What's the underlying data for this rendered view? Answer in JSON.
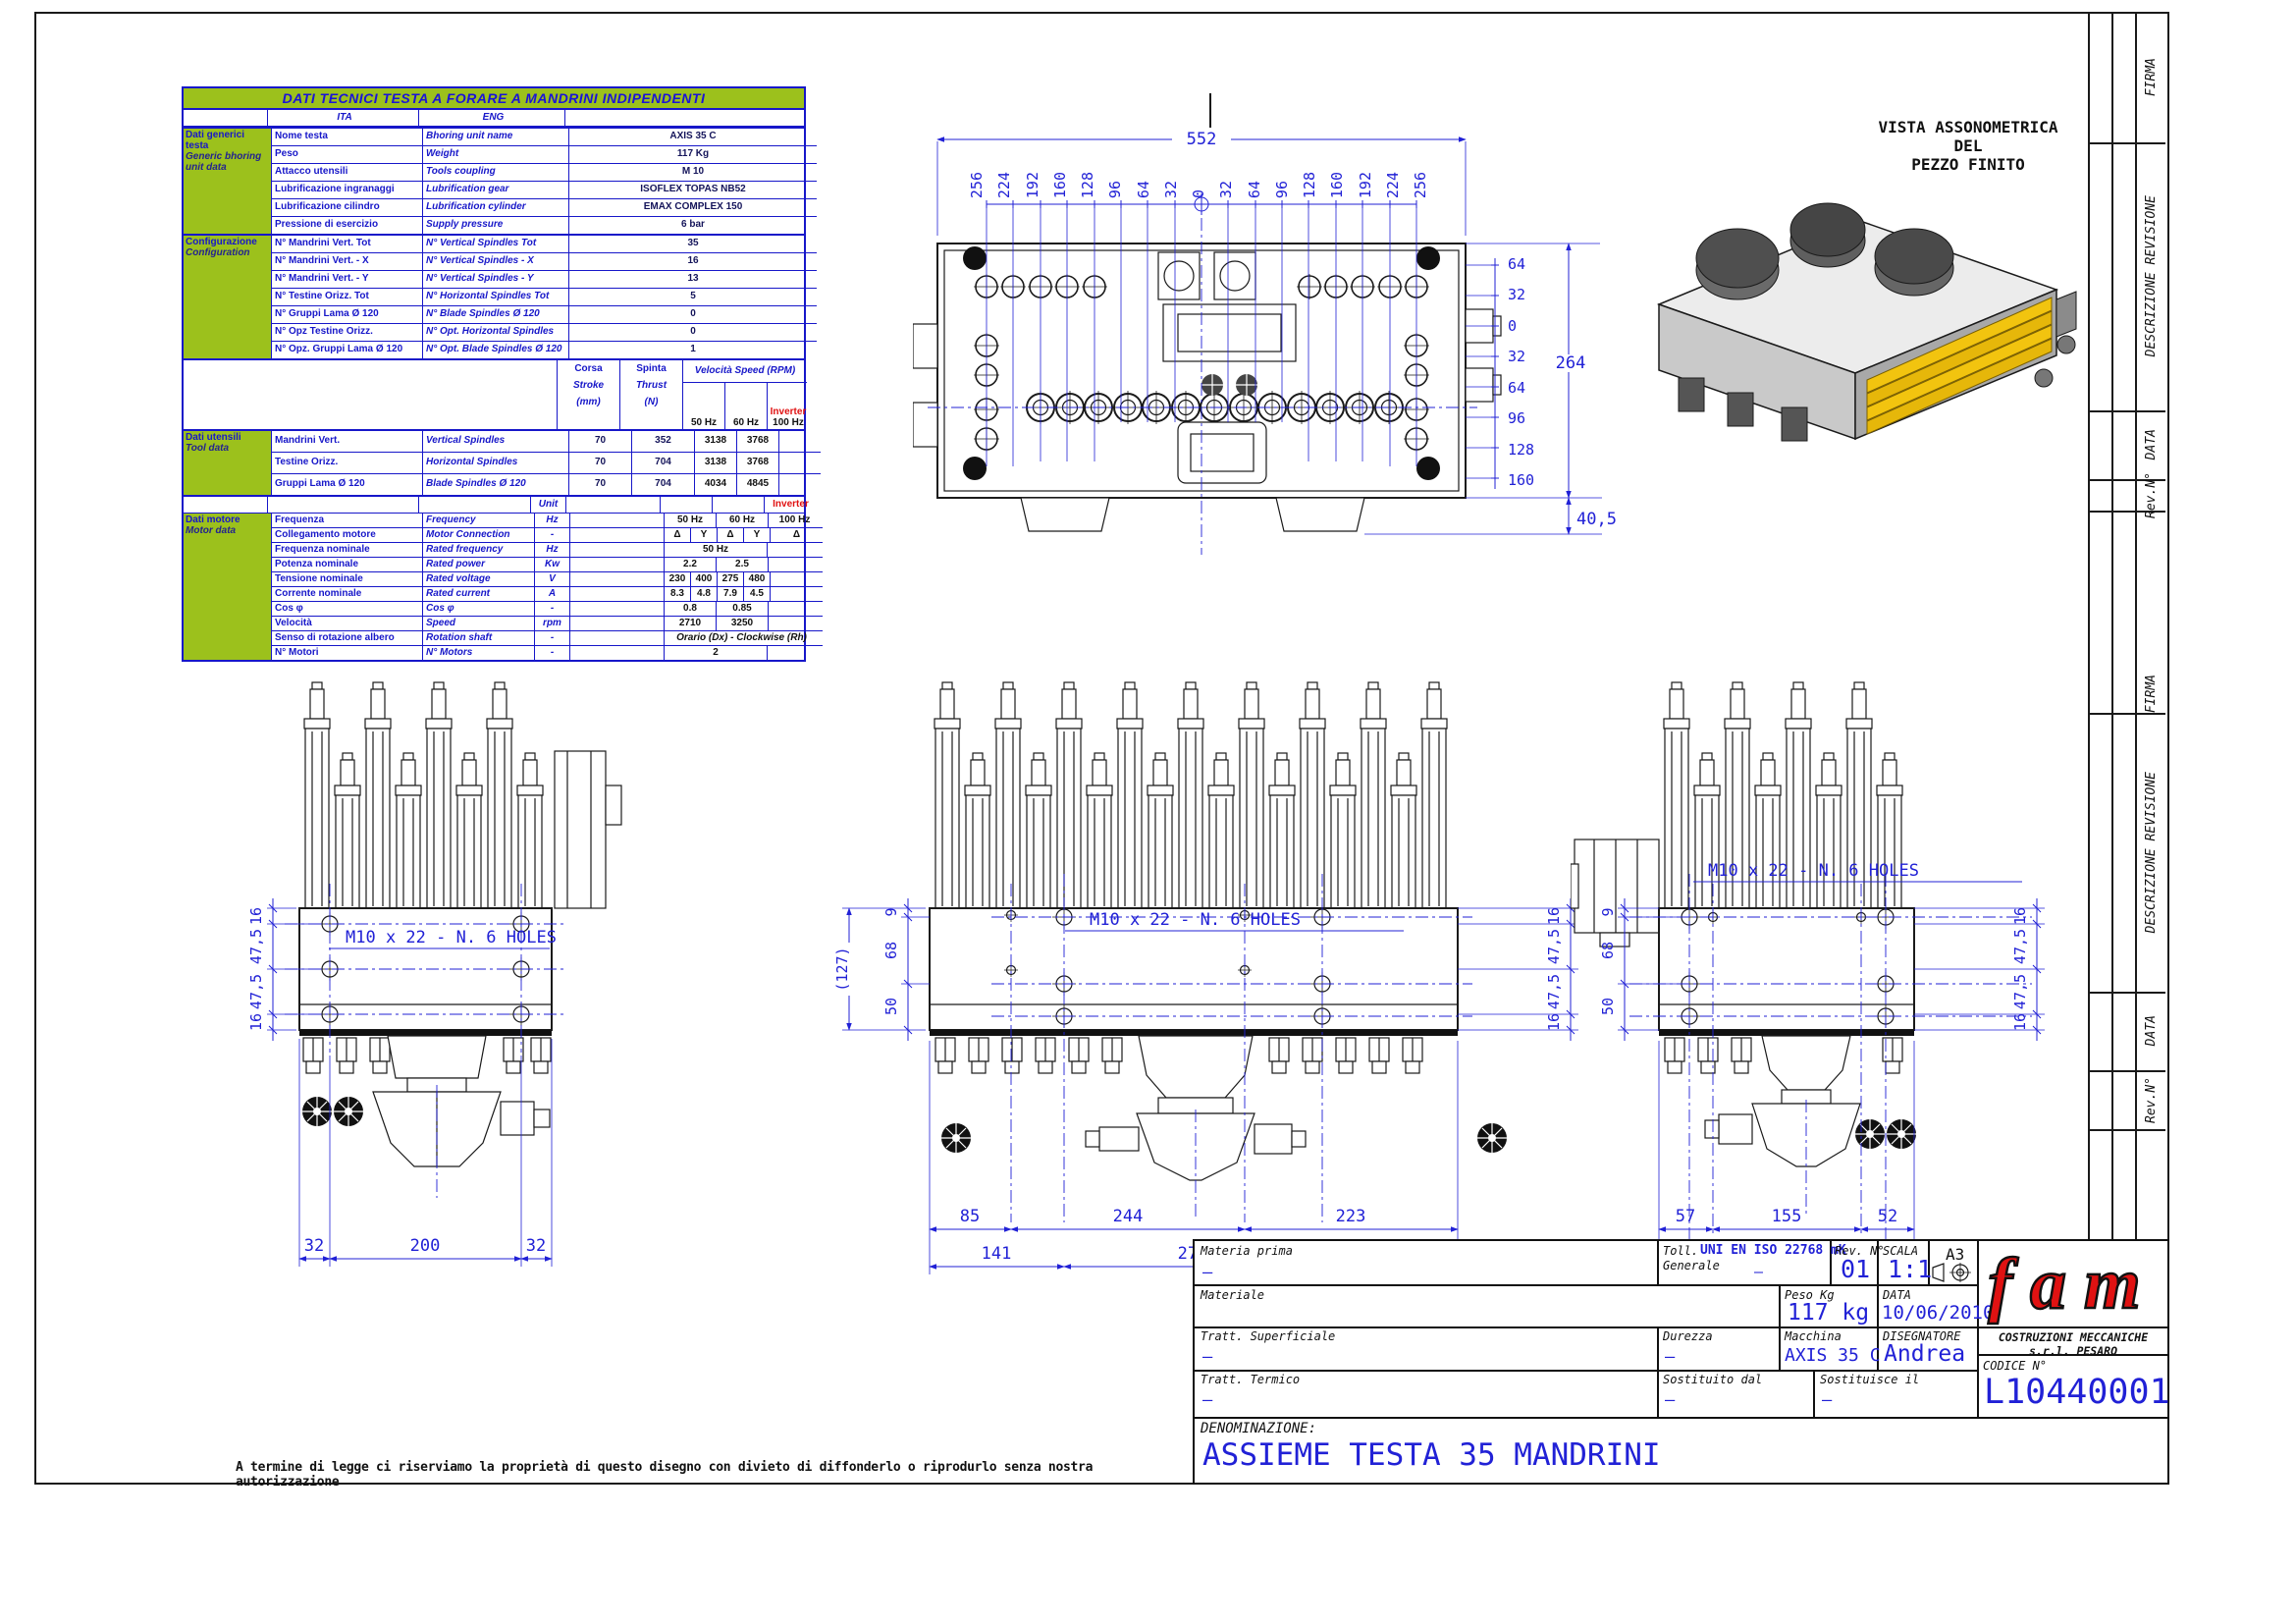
{
  "sheet": {
    "disclaimer": "A termine di legge ci riserviamo la proprietà di questo disegno con divieto di diffonderlo o riprodurlo senza nostra autorizzazione"
  },
  "colors": {
    "accent_blue": "#2121d6",
    "table_green": "#9cc11c",
    "logo_red": "#e01212"
  },
  "revision_strip": {
    "labels": [
      "FIRMA",
      "DESCRIZIONE REVISIONE",
      "DATA",
      "Rev.N°"
    ]
  },
  "tech_table": {
    "title": "DATI TECNICI TESTA A FORARE A MANDRINI INDIPENDENTI",
    "col_ita": "ITA",
    "col_eng": "ENG",
    "generic": {
      "label_ita": "Dati generici testa",
      "label_eng": "Generic bhoring unit data",
      "rows": [
        {
          "ita": "Nome testa",
          "eng": "Bhoring unit name",
          "val": "AXIS 35 C"
        },
        {
          "ita": "Peso",
          "eng": "Weight",
          "val": "117 Kg"
        },
        {
          "ita": "Attacco utensili",
          "eng": "Tools coupling",
          "val": "M 10"
        },
        {
          "ita": "Lubrificazione ingranaggi",
          "eng": "Lubrification gear",
          "val": "ISOFLEX TOPAS NB52"
        },
        {
          "ita": "Lubrificazione cilindro",
          "eng": "Lubrification cylinder",
          "val": "EMAX COMPLEX 150"
        },
        {
          "ita": "Pressione di esercizio",
          "eng": "Supply pressure",
          "val": "6 bar"
        }
      ]
    },
    "configuration": {
      "label_ita": "Configurazione",
      "label_eng": "Configuration",
      "rows": [
        {
          "ita": "N° Mandrini Vert. Tot",
          "eng": "N° Vertical Spindles Tot",
          "val": "35"
        },
        {
          "ita": "N° Mandrini Vert. - X",
          "eng": "N° Vertical Spindles - X",
          "val": "16"
        },
        {
          "ita": "N° Mandrini Vert. - Y",
          "eng": "N° Vertical Spindles - Y",
          "val": "13"
        },
        {
          "ita": "N° Testine Orizz. Tot",
          "eng": "N° Horizontal Spindles Tot",
          "val": "5"
        },
        {
          "ita": "N° Gruppi Lama Ø 120",
          "eng": "N° Blade Spindles Ø 120",
          "val": "0"
        },
        {
          "ita": "N° Opz Testine Orizz.",
          "eng": "N° Opt. Horizontal Spindles",
          "val": "0"
        },
        {
          "ita": "N° Opz. Gruppi Lama Ø 120",
          "eng": "N° Opt. Blade Spindles Ø 120",
          "val": "1"
        }
      ]
    },
    "speed_header": {
      "corsa": "Corsa",
      "stroke": "Stroke",
      "mm": "(mm)",
      "spinta": "Spinta",
      "thrust": "Thrust",
      "n": "(N)",
      "velocita": "Velocità Speed   (RPM)",
      "hz50": "50 Hz",
      "hz60": "60 Hz",
      "inverter": "Inverter",
      "hz100": "100 Hz"
    },
    "tools": {
      "label_ita": "Dati utensili",
      "label_eng": "Tool data",
      "rows": [
        {
          "ita": "Mandrini Vert.",
          "eng": "Vertical Spindles",
          "corsa": "70",
          "spinta": "352",
          "hz50": "3138",
          "hz60": "3768"
        },
        {
          "ita": "Testine Orizz.",
          "eng": "Horizontal Spindles",
          "corsa": "70",
          "spinta": "704",
          "hz50": "3138",
          "hz60": "3768"
        },
        {
          "ita": "Gruppi Lama Ø 120",
          "eng": "Blade Spindles Ø 120",
          "corsa": "70",
          "spinta": "704",
          "hz50": "4034",
          "hz60": "4845"
        }
      ]
    },
    "unit_header": {
      "unit": "Unit",
      "inverter": "Inverter"
    },
    "motor": {
      "label_ita": "Dati motore",
      "label_eng": "Motor data",
      "rows": [
        {
          "ita": "Frequenza",
          "eng": "Frequency",
          "unit": "Hz",
          "cells": [
            "50 Hz",
            "60 Hz",
            "100 Hz"
          ]
        },
        {
          "ita": "Collegamento motore",
          "eng": "Motor Connection",
          "unit": "-",
          "cells": [
            "Δ",
            "Y",
            "Δ",
            "Y",
            "Δ"
          ]
        },
        {
          "ita": "Frequenza nominale",
          "eng": "Rated frequency",
          "unit": "Hz",
          "cells": [
            "50 Hz"
          ]
        },
        {
          "ita": "Potenza nominale",
          "eng": "Rated power",
          "unit": "Kw",
          "cells": [
            "2.2",
            "2.5"
          ]
        },
        {
          "ita": "Tensione nominale",
          "eng": "Rated voltage",
          "unit": "V",
          "cells": [
            "230",
            "400",
            "275",
            "480"
          ]
        },
        {
          "ita": "Corrente nominale",
          "eng": "Rated current",
          "unit": "A",
          "cells": [
            "8.3",
            "4.8",
            "7.9",
            "4.5"
          ]
        },
        {
          "ita": "Cos φ",
          "eng": "Cos φ",
          "unit": "-",
          "cells": [
            "0.8",
            "0.85"
          ]
        },
        {
          "ita": "Velocità",
          "eng": "Speed",
          "unit": "rpm",
          "cells": [
            "2710",
            "3250"
          ]
        },
        {
          "ita": "Senso di rotazione albero",
          "eng": "Rotation shaft",
          "unit": "-",
          "cells": [
            "Orario (Dx) - Clockwise (Rh)"
          ]
        },
        {
          "ita": "N° Motori",
          "eng": "N° Motors",
          "unit": "-",
          "cells": [
            "2"
          ]
        }
      ]
    }
  },
  "top_view": {
    "dim_total": "552",
    "x_ticks": [
      "256",
      "224",
      "192",
      "160",
      "128",
      "96",
      "64",
      "32",
      "0",
      "32",
      "64",
      "96",
      "128",
      "160",
      "192",
      "224",
      "256"
    ],
    "y_ticks": [
      "64",
      "32",
      "0",
      "32",
      "64",
      "96",
      "128",
      "160"
    ],
    "dim_height": "264",
    "dim_offset": "40,5"
  },
  "iso_view": {
    "title_line1": "VISTA ASSONOMETRICA",
    "title_line2": "DEL",
    "title_line3": "PEZZO FINITO"
  },
  "front_views": {
    "hole_note": "M10  x 22 - N. 6 HOLES",
    "left": {
      "left_dims": [
        "16",
        "47,5",
        "47,5",
        "16"
      ],
      "bottom": [
        "32",
        "200",
        "32"
      ]
    },
    "middle": {
      "overall": "(127)",
      "left_dims": [
        "9",
        "68",
        "50"
      ],
      "right_dims": [
        "16",
        "47,5",
        "47,5",
        "16"
      ],
      "bottom_row1": [
        "85",
        "244",
        "223"
      ],
      "bottom_row2": [
        "141",
        "270",
        "141"
      ]
    },
    "right": {
      "left_dims": [
        "9",
        "68",
        "50"
      ],
      "right_dims": [
        "16",
        "47,5",
        "47,5",
        "16"
      ],
      "bottom_row1": [
        "57",
        "155",
        "52"
      ],
      "bottom_row2": [
        "32",
        "200",
        "32"
      ]
    }
  },
  "title_block": {
    "materia_prima_label": "Materia prima",
    "materia_prima_value": "–",
    "toll_label1": "Toll.",
    "toll_label2": "Generale",
    "toll_value": "UNI EN ISO 22768 mK",
    "toll_dash": "–",
    "rev_label": "Rev. N°",
    "rev_value": "01",
    "scala_label": "SCALA",
    "scala_value": "1:1",
    "format": "A3",
    "materiale_label": "Materiale",
    "peso_label": "Peso Kg",
    "peso_value": "117 kg",
    "data_label": "DATA",
    "data_value": "10/06/2010",
    "tratt_sup_label": "Tratt. Superficiale",
    "tratt_sup_value": "–",
    "durezza_label": "Durezza",
    "durezza_value": "–",
    "macchina_label": "Macchina",
    "macchina_value": "AXIS 35 C",
    "disegnatore_label": "DISEGNATORE",
    "disegnatore_value": "Andrea",
    "tratt_term_label": "Tratt. Termico",
    "tratt_term_value": "–",
    "sost_dal_label": "Sostituito dal",
    "sost_dal_value": "–",
    "sost_il_label": "Sostituisce il",
    "sost_il_value": "–",
    "logo": "fam",
    "company": "COSTRUZIONI MECCANICHE s.r.l. PESARO",
    "codice_label": "CODICE N°",
    "codice_value": "L10440001",
    "denominazione_label": "DENOMINAZIONE:",
    "denominazione_value": "ASSIEME TESTA 35 MANDRINI"
  }
}
